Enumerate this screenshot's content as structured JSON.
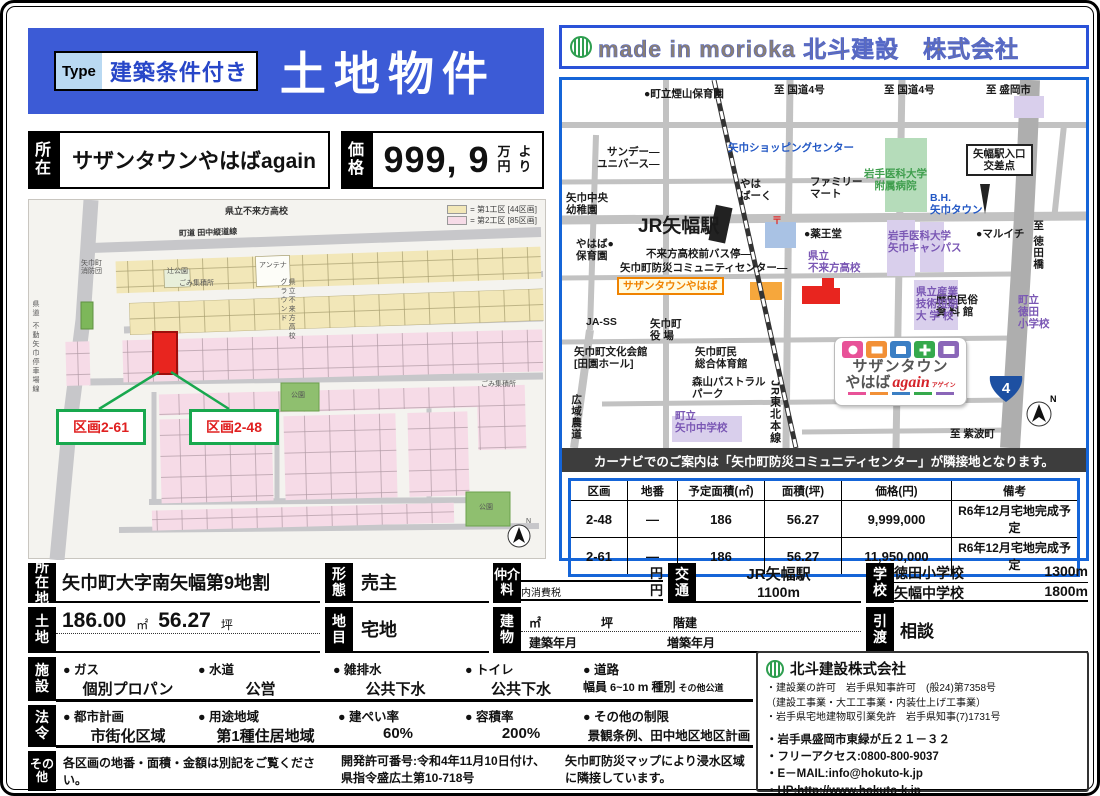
{
  "colors": {
    "banner_blue": "#3c5bd6",
    "panel_border": "#1565d8",
    "highlight_red": "#e8251f",
    "callout_green": "#18a84e",
    "lot_block1": "#f2e7b8",
    "lot_block2": "#f6dbe7",
    "brand_green": "#2e9e4f"
  },
  "header": {
    "type_label": "Type",
    "type_value": "建築条件付き",
    "title": "土地物件",
    "company_banner": "made in morioka 北斗建設　株式会社"
  },
  "location_bar": {
    "shozai_label": "所在",
    "shozai_value": "サザンタウンやはばagain",
    "price_label": "価格",
    "price_value": "999, 9",
    "price_man": "万",
    "price_yen": "円",
    "price_yo": "よ",
    "price_ri": "り"
  },
  "site_plan": {
    "legend1": {
      "label": "= 第1工区 [44区画]",
      "color": "#f2e7b8"
    },
    "legend2": {
      "label": "= 第2工区 [85区画]",
      "color": "#f6dbe7"
    },
    "labels": {
      "school_top": "県立不来方高校",
      "road_top": "町道 田中縦道線",
      "road_left": "県道 不動矢巾停車場線",
      "ground": "県立不来方高校\nグラウンド",
      "shobodan": "矢巾町\n消防団",
      "antenna": "アンテナ",
      "tsuji": "辻公園",
      "gomi1": "ごみ集積所",
      "gomi2": "ごみ集積所",
      "park1": "公園",
      "park2": "公園",
      "north": "N",
      "callout_61": "区画2-61",
      "callout_48": "区画2-48"
    }
  },
  "map": {
    "caption": "カーナビでのご案内は「矢巾町防災コミュニティセンター」が隣接地となります。",
    "route_shield": "4",
    "labels": {
      "hiyama": "●町立煙山保育園",
      "kokudo4a": "至 国道4号",
      "kokudo4b": "至 国道4号",
      "morioka": "至 盛岡市",
      "sunday": "サンデー―\nユニバース―",
      "shopping": "矢巾ショッピングセンター",
      "yahaba_park": "やは\nばーく",
      "family": "ファミリー\nマート",
      "chuo_yochien": "矢巾中央\n幼稚園",
      "station": "JR矢幅駅",
      "ekiguchi": "矢幅駅入口\n交差点",
      "idai_byoin": "岩手医科大学\n附属病院",
      "bh_town": "B.H.\n矢巾タウン",
      "yakuodo": "●薬王堂",
      "maruichi": "●マルイチ",
      "tokudabashi": "至 徳田橋",
      "yahaba_hoikuen": "やはば●\n保育園",
      "bus_stop": "不来方高校前バス停―",
      "bosai": "矢巾町防災コミュニティセンター―",
      "kozukata": "県立\n不来方高校",
      "southern": "サザンタウンやはば",
      "ja_ss": "JA-SS",
      "yakuba": "矢巾町\n役 場",
      "rekishi": "歴史民俗\n資 料 館",
      "tokuda_sho": "町立\n徳田\n小学校",
      "bunka": "矢巾町文化会館\n[田園ホール]",
      "taiiku": "矢巾町民\n総合体育館",
      "pastoral": "森山パストラル\nパーク",
      "sangyo": "県立産業\n技術短期\n大 学 校",
      "koiki": "広域農道",
      "yahaba_chu": "町立\n矢巾中学校",
      "jr_line": "JR東北本線",
      "shiwa": "至 紫波町",
      "idai_campus": "岩手医科大学\n矢巾キャンパス",
      "post": "〒",
      "north": "N"
    },
    "logo": {
      "line1": "サザンタウン",
      "line2": "やはば",
      "again": "again",
      "kana": "アゲイン"
    }
  },
  "price_table": {
    "headers": {
      "kukaku": "区画",
      "chiban": "地番",
      "area_m2": "予定面積(㎡)",
      "area_tsubo": "面積(坪)",
      "price": "価格(円)",
      "note": "備考"
    },
    "rows": [
      {
        "kukaku": "2-48",
        "chiban": "—",
        "area_m2": "186",
        "area_tsubo": "56.27",
        "price": "9,999,000",
        "note": "R6年12月宅地完成予定"
      },
      {
        "kukaku": "2-61",
        "chiban": "—",
        "area_m2": "186",
        "area_tsubo": "56.27",
        "price": "11,950,000",
        "note": "R6年12月宅地完成予定"
      }
    ]
  },
  "details": {
    "shozaichi": {
      "label": "所在地",
      "value": "矢巾町大字南矢幅第9地割"
    },
    "keitai": {
      "label": "形態",
      "value": "売主"
    },
    "chukai": {
      "label": "仲介料",
      "yen1": "円",
      "tax": "内消費税",
      "yen2": "円"
    },
    "kotsu": {
      "label": "交通",
      "line1": "JR矢幅駅",
      "line2": "1100m"
    },
    "gakko": {
      "label": "学校",
      "s1": "徳田小学校",
      "d1": "1300m",
      "s2": "矢幅中学校",
      "d2": "1800m"
    },
    "tochi": {
      "label": "土地",
      "m2": "186.00",
      "u_m2": "㎡",
      "tsubo": "56.27",
      "u_tsubo": "坪"
    },
    "chimoku": {
      "label": "地目",
      "value": "宅地"
    },
    "tatemono": {
      "label": "建物",
      "u1": "㎡",
      "u2": "坪",
      "u3": "階建",
      "b1": "建築年月",
      "b2": "増築年月"
    },
    "hikiwatashi": {
      "label": "引渡",
      "value": "相談"
    },
    "shisetsu": {
      "label": "施設",
      "bullet": "●",
      "i1": {
        "name": "ガス",
        "value": "個別プロパン"
      },
      "i2": {
        "name": "水道",
        "value": "公営"
      },
      "i3": {
        "name": "雑排水",
        "value": "公共下水"
      },
      "i4": {
        "name": "トイレ",
        "value": "公共下水"
      },
      "i5": {
        "name": "道路",
        "haba": "幅員",
        "range": "6~10",
        "unit": "m",
        "shubetsu": "種別",
        "kind": "その他公道"
      }
    },
    "horei": {
      "label": "法令",
      "bullet": "●",
      "i1": {
        "name": "都市計画",
        "value": "市街化区域"
      },
      "i2": {
        "name": "用途地域",
        "value": "第1種住居地域"
      },
      "i3": {
        "name": "建ぺい率",
        "value": "60%"
      },
      "i4": {
        "name": "容積率",
        "value": "200%"
      },
      "i5": {
        "name": "その他の制限",
        "value": "景観条例、田中地区地区計画"
      }
    },
    "sonota": {
      "label": "その他",
      "note1": "各区画の地番・面積・金額は別記をご覧ください。",
      "note2": "開発許可番号:令和4年11月10日付け、県指令盛広土第10-718号",
      "note3": "矢巾町防災マップにより浸水区域に隣接しています。"
    }
  },
  "company": {
    "name": "北斗建設株式会社",
    "lic1": "・建設業の許可　岩手県知事許可　(般24)第7358号",
    "lic1b": "（建設工事業・大工工事業・内装仕上げ工事業）",
    "lic2": "・岩手県宅地建物取引業免許　岩手県知事(7)1731号",
    "addr": "・岩手県盛岡市東緑が丘２１－３２",
    "free": "・フリーアクセス:0800-800-9037",
    "email": "・E－MAIL:info@hokuto-k.jp",
    "hp": "・HP:http://www.hokuto-k.jp"
  }
}
